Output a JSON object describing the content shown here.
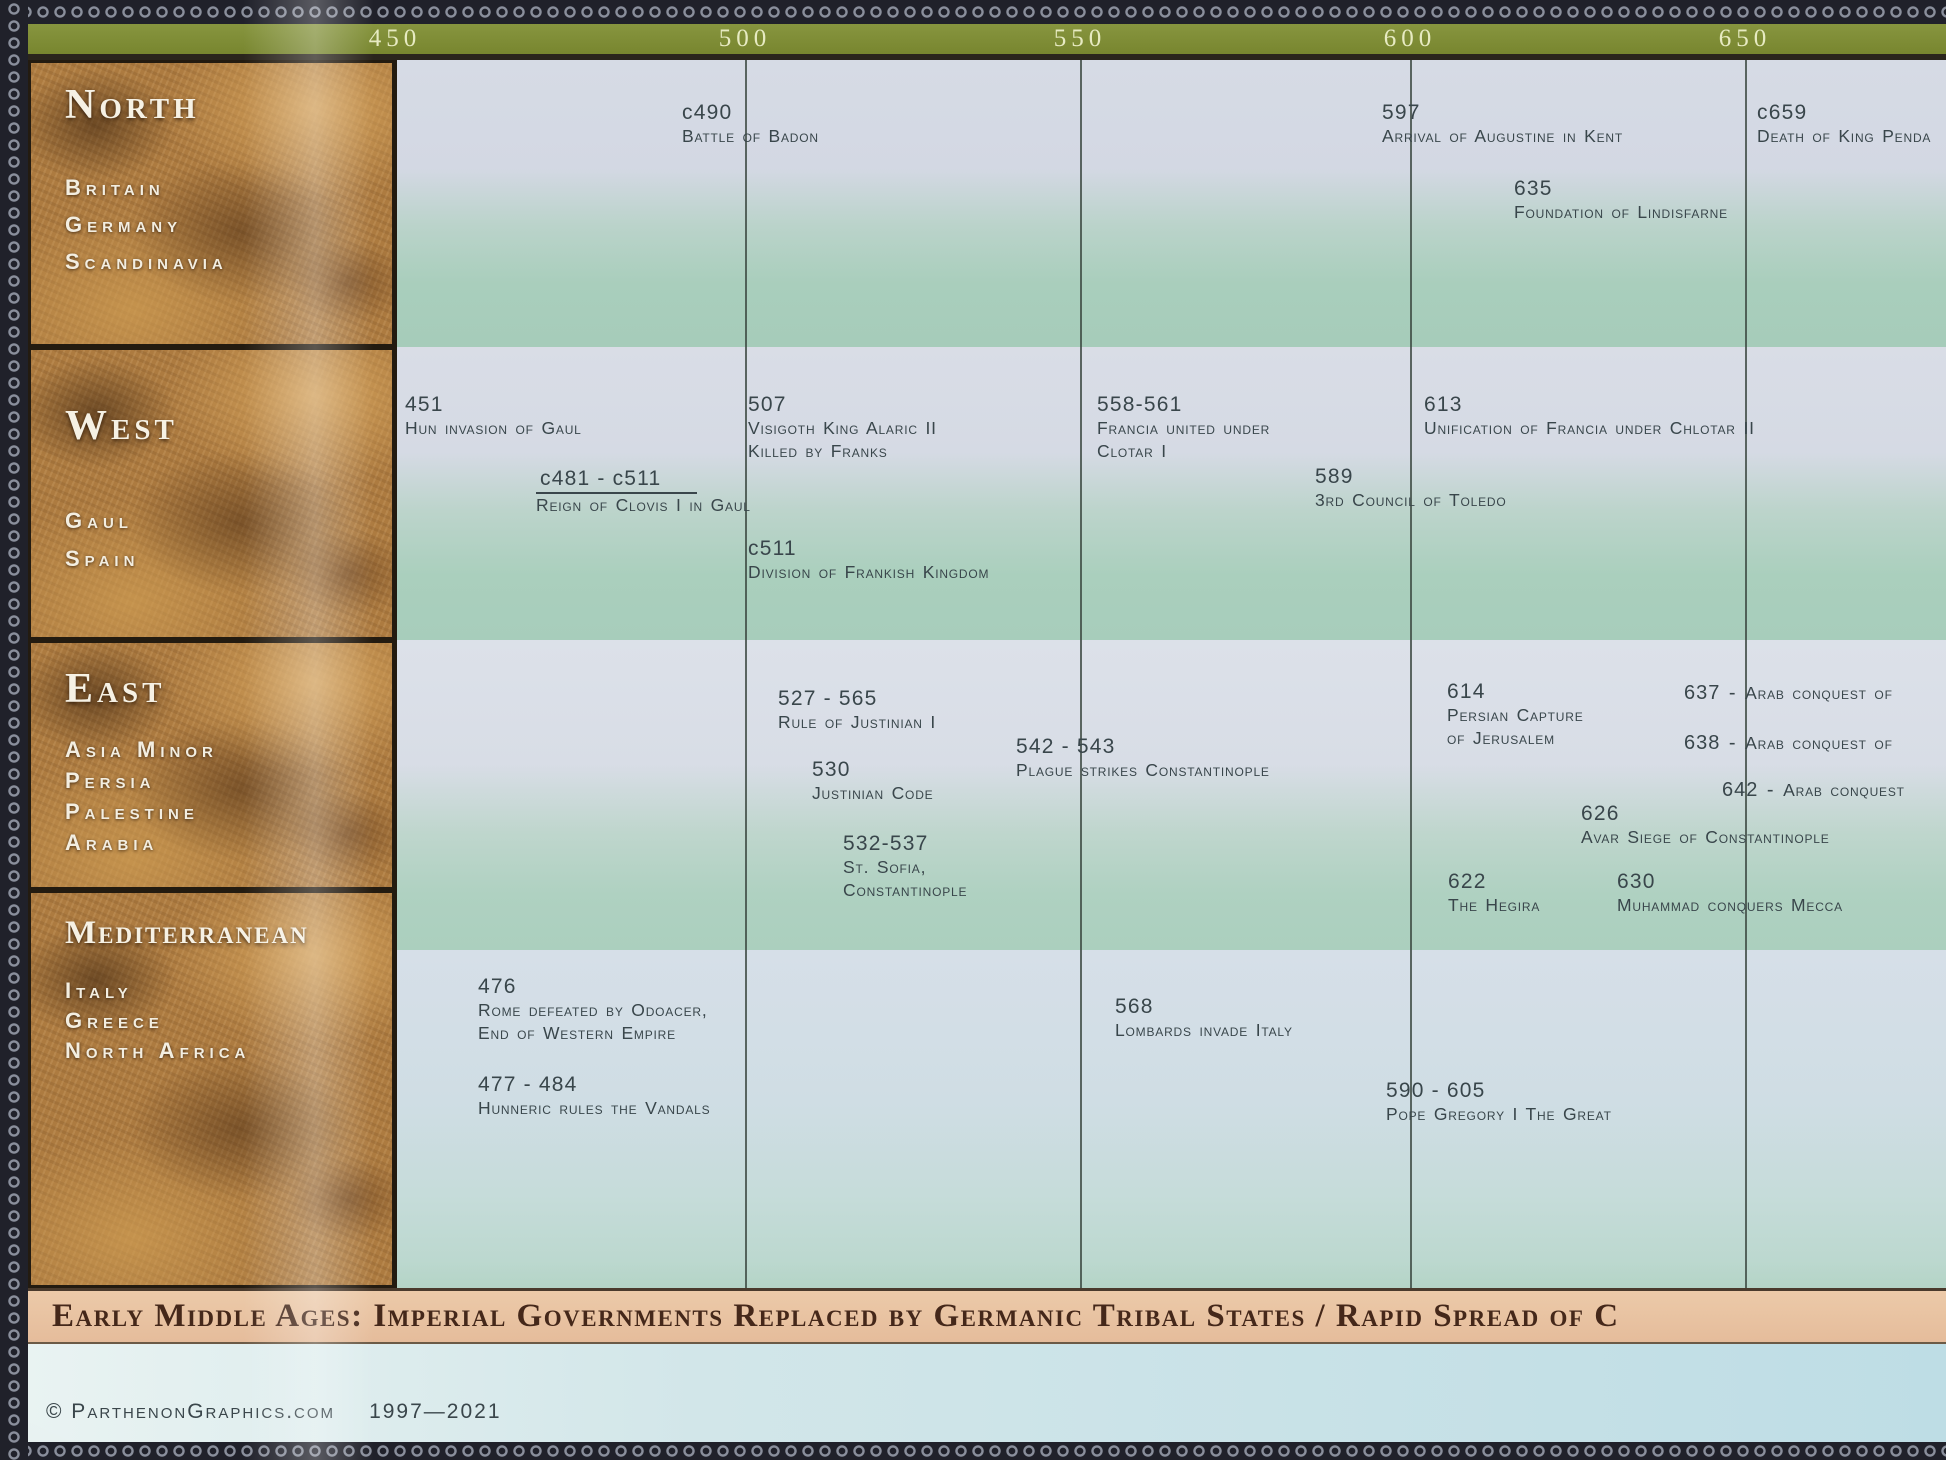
{
  "header": {
    "years": [
      {
        "label": "450",
        "x": 395
      },
      {
        "label": "500",
        "x": 745
      },
      {
        "label": "550",
        "x": 1080
      },
      {
        "label": "600",
        "x": 1410
      },
      {
        "label": "650",
        "x": 1745
      }
    ]
  },
  "gridlines": [
    {
      "year": "500",
      "x": 745
    },
    {
      "year": "550",
      "x": 1080
    },
    {
      "year": "600",
      "x": 1410
    },
    {
      "year": "650",
      "x": 1745
    }
  ],
  "rows": [
    {
      "id": "north",
      "label": "North band"
    },
    {
      "id": "west",
      "label": "West band"
    },
    {
      "id": "east",
      "label": "East band"
    },
    {
      "id": "med",
      "label": "Mediterranean band"
    }
  ],
  "sidebar": {
    "panels": [
      {
        "id": "north",
        "title": "North",
        "regions": [
          "Britain",
          "Germany",
          "Scandinavia"
        ],
        "top": 60,
        "height": 287,
        "title_dy": 18,
        "regions_dy": 112,
        "region_gap": 37
      },
      {
        "id": "west",
        "title": "West",
        "regions": [
          "Gaul",
          "Spain"
        ],
        "top": 347,
        "height": 293,
        "title_dy": 52,
        "regions_dy": 158,
        "region_gap": 38
      },
      {
        "id": "east",
        "title": "East",
        "regions": [
          "Asia Minor",
          "Persia",
          "Palestine",
          "Arabia"
        ],
        "top": 640,
        "height": 250,
        "title_dy": 22,
        "regions_dy": 94,
        "region_gap": 31
      },
      {
        "id": "med",
        "title": "Mediterranean",
        "regions": [
          "Italy",
          "Greece",
          "North Africa"
        ],
        "top": 890,
        "height": 398,
        "title_dy": 22,
        "regions_dy": 85,
        "region_gap": 30
      }
    ]
  },
  "events": [
    {
      "row": "north",
      "date": "c490",
      "lines": [
        "Battle of Badon"
      ],
      "x": 682,
      "y": 100
    },
    {
      "row": "north",
      "date": "597",
      "lines": [
        "Arrival of Augustine in Kent"
      ],
      "x": 1382,
      "y": 100
    },
    {
      "row": "north",
      "date": "635",
      "lines": [
        "Foundation of Lindisfarne"
      ],
      "x": 1514,
      "y": 176
    },
    {
      "row": "north",
      "date": "c659",
      "lines": [
        "Death of King Penda"
      ],
      "x": 1757,
      "y": 100
    },
    {
      "row": "west",
      "date": "451",
      "lines": [
        "Hun invasion of Gaul"
      ],
      "x": 405,
      "y": 392
    },
    {
      "row": "west",
      "date": "507",
      "lines": [
        "Visigoth King Alaric II",
        "Killed by Franks"
      ],
      "x": 748,
      "y": 392
    },
    {
      "row": "west",
      "date": "c481 - c511",
      "underline": true,
      "lines": [
        "Reign of Clovis I in Gaul"
      ],
      "x": 536,
      "y": 466
    },
    {
      "row": "west",
      "date": "c511",
      "lines": [
        "Division of Frankish Kingdom"
      ],
      "x": 748,
      "y": 536
    },
    {
      "row": "west",
      "date": "558-561",
      "lines": [
        "Francia united under",
        "Clotar I"
      ],
      "x": 1097,
      "y": 392
    },
    {
      "row": "west",
      "date": "613",
      "lines": [
        "Unification of Francia under Chlotar II"
      ],
      "x": 1424,
      "y": 392
    },
    {
      "row": "west",
      "date": "589",
      "lines": [
        "3rd Council of Toledo"
      ],
      "x": 1315,
      "y": 464
    },
    {
      "row": "east",
      "date": "527 - 565",
      "lines": [
        "Rule of Justinian I"
      ],
      "x": 778,
      "y": 686
    },
    {
      "row": "east",
      "date": "530",
      "lines": [
        "Justinian Code"
      ],
      "x": 812,
      "y": 757
    },
    {
      "row": "east",
      "date": "532-537",
      "lines": [
        "St. Sofia,",
        "Constantinople"
      ],
      "x": 843,
      "y": 831
    },
    {
      "row": "east",
      "date": "542 - 543",
      "lines": [
        "Plague strikes Constantinople"
      ],
      "x": 1016,
      "y": 734
    },
    {
      "row": "east",
      "date": "614",
      "lines": [
        "Persian Capture",
        "of Jerusalem"
      ],
      "x": 1447,
      "y": 679
    },
    {
      "row": "east",
      "date": "637",
      "inline": true,
      "lines": [
        "Arab conquest of"
      ],
      "x": 1684,
      "y": 682
    },
    {
      "row": "east",
      "date": "638",
      "inline": true,
      "lines": [
        "Arab conquest of"
      ],
      "x": 1684,
      "y": 732
    },
    {
      "row": "east",
      "date": "642",
      "inline": true,
      "lines": [
        "Arab conquest"
      ],
      "x": 1722,
      "y": 779
    },
    {
      "row": "east",
      "date": "626",
      "lines": [
        "Avar Siege of Constantinople"
      ],
      "x": 1581,
      "y": 801
    },
    {
      "row": "east",
      "date": "622",
      "lines": [
        "The Hegira"
      ],
      "x": 1448,
      "y": 869
    },
    {
      "row": "east",
      "date": "630",
      "lines": [
        "Muhammad conquers Mecca"
      ],
      "x": 1617,
      "y": 869
    },
    {
      "row": "med",
      "date": "476",
      "lines": [
        "Rome defeated by Odoacer,",
        "End of Western Empire"
      ],
      "x": 478,
      "y": 974
    },
    {
      "row": "med",
      "date": "477 - 484",
      "lines": [
        "Hunneric rules the Vandals"
      ],
      "x": 478,
      "y": 1072
    },
    {
      "row": "med",
      "date": "568",
      "lines": [
        "Lombards invade Italy"
      ],
      "x": 1115,
      "y": 994
    },
    {
      "row": "med",
      "date": "590 - 605",
      "lines": [
        "Pope Gregory I The Great"
      ],
      "x": 1386,
      "y": 1078
    }
  ],
  "banner": {
    "text": "Early Middle Ages:  Imperial Governments Replaced by Germanic Tribal States / Rapid Spread of C"
  },
  "footer": {
    "copyright": "© ParthenonGraphics.com",
    "date_range": "1997—2021"
  },
  "colors": {
    "year_bar": "#7e8c3c",
    "band_light": "#d6dbe5",
    "band_green": "#a8cdbb",
    "banner_tan": "#e9c3a4",
    "banner_text": "#45281a",
    "event_text": "#39464b",
    "footer_blue": "#bedde5",
    "border_dark": "#20212a",
    "map_brown": "#ad7b40"
  }
}
